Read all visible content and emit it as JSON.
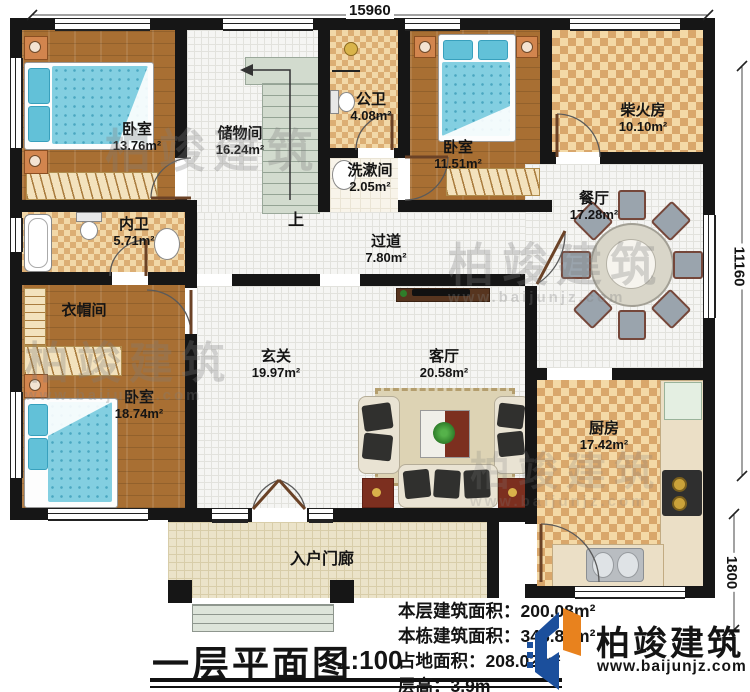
{
  "title": {
    "text": "一层平面图",
    "scale": "1:100"
  },
  "dimensions": {
    "top": "15960",
    "right": "11160",
    "porch": "1800"
  },
  "rooms": [
    {
      "id": "bedroom1",
      "name": "卧室",
      "area": "13.76m²"
    },
    {
      "id": "storage",
      "name": "储物间",
      "area": "16.24m²"
    },
    {
      "id": "public-bath",
      "name": "公卫",
      "area": "4.08m²"
    },
    {
      "id": "washroom",
      "name": "洗漱间",
      "area": "2.05m²"
    },
    {
      "id": "bedroom2",
      "name": "卧室",
      "area": "11.51m²"
    },
    {
      "id": "firewood-room",
      "name": "柴火房",
      "area": "10.10m²"
    },
    {
      "id": "dining-room",
      "name": "餐厅",
      "area": "17.28m²"
    },
    {
      "id": "ensuite-bath",
      "name": "内卫",
      "area": "5.71m²"
    },
    {
      "id": "cloakroom",
      "name": "衣帽间",
      "area": ""
    },
    {
      "id": "bedroom3",
      "name": "卧室",
      "area": "18.74m²"
    },
    {
      "id": "hallway",
      "name": "过道",
      "area": "7.80m²"
    },
    {
      "id": "foyer",
      "name": "玄关",
      "area": "19.97m²"
    },
    {
      "id": "living-room",
      "name": "客厅",
      "area": "20.58m²"
    },
    {
      "id": "kitchen",
      "name": "厨房",
      "area": "17.42m²"
    },
    {
      "id": "entry-porch",
      "name": "入户门廊",
      "area": ""
    }
  ],
  "stairs": {
    "up_label": "上"
  },
  "stats": [
    {
      "label": "本层建筑面积：",
      "value": "200.08m²"
    },
    {
      "label": "本栋建筑面积：",
      "value": "348.87m²"
    },
    {
      "label": "占地面积：",
      "value": "208.02m²"
    },
    {
      "label": "层高：",
      "value": "3.9m"
    }
  ],
  "logo": {
    "name": "柏竣建筑",
    "url": "www.baijunjz.com"
  },
  "watermark": {
    "name": "柏竣建筑",
    "url": "www.baijunjz.com"
  },
  "colors": {
    "wall": "#161616",
    "tile": "#d9a76b",
    "wood": "#a86f33",
    "logo_blue": "#1b4f9c",
    "logo_orange": "#e8821e"
  }
}
